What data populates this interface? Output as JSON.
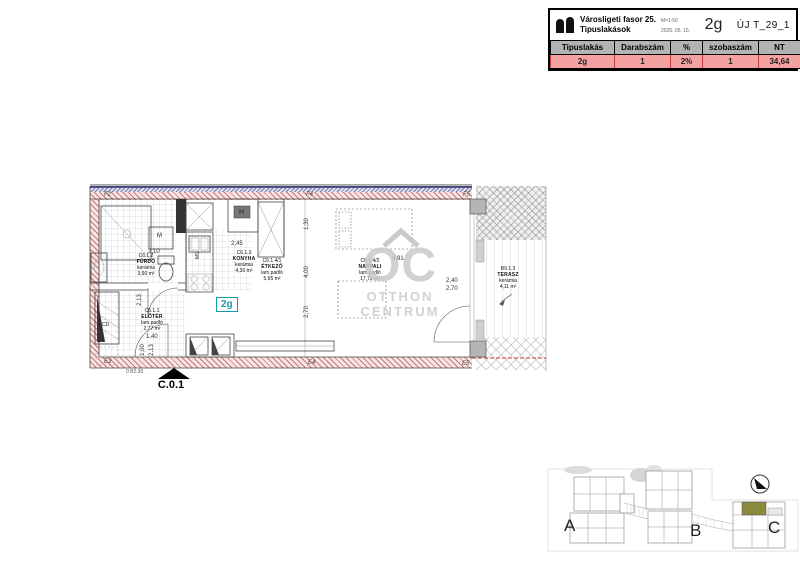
{
  "title_block": {
    "project": "Városligeti fasor 25.",
    "scale": "M=1:50",
    "subtitle": "Tipuslakások",
    "date": "2025. 05. 15.",
    "unit_code": "2g",
    "drawing_code": "ÚJ T_29_1",
    "table": {
      "h0": "Tipuslakás",
      "h1": "Darabszám",
      "h2": "%",
      "h3": "szobaszám",
      "h4": "NT",
      "r0": "2g",
      "r1": "1",
      "r2": "2%",
      "r3": "1",
      "r4": "34,64"
    },
    "colors": {
      "row_bg": "#f4a1a1",
      "header_bg": "#b3b3b3"
    }
  },
  "floor_plan": {
    "unit_label": "2g",
    "entrance_label": "C.0.1",
    "entrance_note": "0 B2.30",
    "accent": "#1899a8",
    "rooms": [
      {
        "code": "C6.1.1",
        "name": "ELŐTÉR",
        "finish": "lam.padló",
        "area": "2,77 m²"
      },
      {
        "code": "C6.1.2",
        "name": "FÜRDŐ",
        "finish": "kerámia",
        "area": "3,90 m²"
      },
      {
        "code": "C6.1.3",
        "name": "KONYHA",
        "finish": "kerámia",
        "area": "4,30 m²"
      },
      {
        "code": "C6.1.4/1",
        "name": "ÉTKEZŐ",
        "finish": "lam.padló",
        "area": "5,95 m²"
      },
      {
        "code": "C6.1.4/2",
        "name": "NAPPALI",
        "finish": "lam.padló",
        "area": "17,72 m²"
      },
      {
        "code": "B9.1.3",
        "name": "TERASZ",
        "finish": "kerámia",
        "area": "4,11 m²"
      }
    ],
    "wall_labels": {
      "f2": "F2",
      "f4": "F4",
      "f5": "F5",
      "e3": "E3",
      "e4": "E4",
      "e5": "E5"
    },
    "dims": {
      "bath_w": "2,10",
      "kitchen_w": "2,45",
      "living_w": "4,91",
      "v1": "1,30",
      "v2": "4,00",
      "v3": "2,70",
      "door_w": "2,40",
      "door_h": "2,70",
      "entry_w": "1,40",
      "entry_1": "1,00",
      "entry_2": "2,13",
      "hall_h": "2,13"
    },
    "appliances": {
      "washer": "M",
      "dishwasher": "MG",
      "shaft": "H",
      "duct": "CD"
    },
    "watermark": {
      "mark": "OC",
      "line1": "OTTHON",
      "line2": "CENTRUM"
    }
  },
  "key_plan": {
    "building_a": "A",
    "building_b": "B",
    "building_c": "C",
    "highlight_color": "#8b8a3f"
  }
}
